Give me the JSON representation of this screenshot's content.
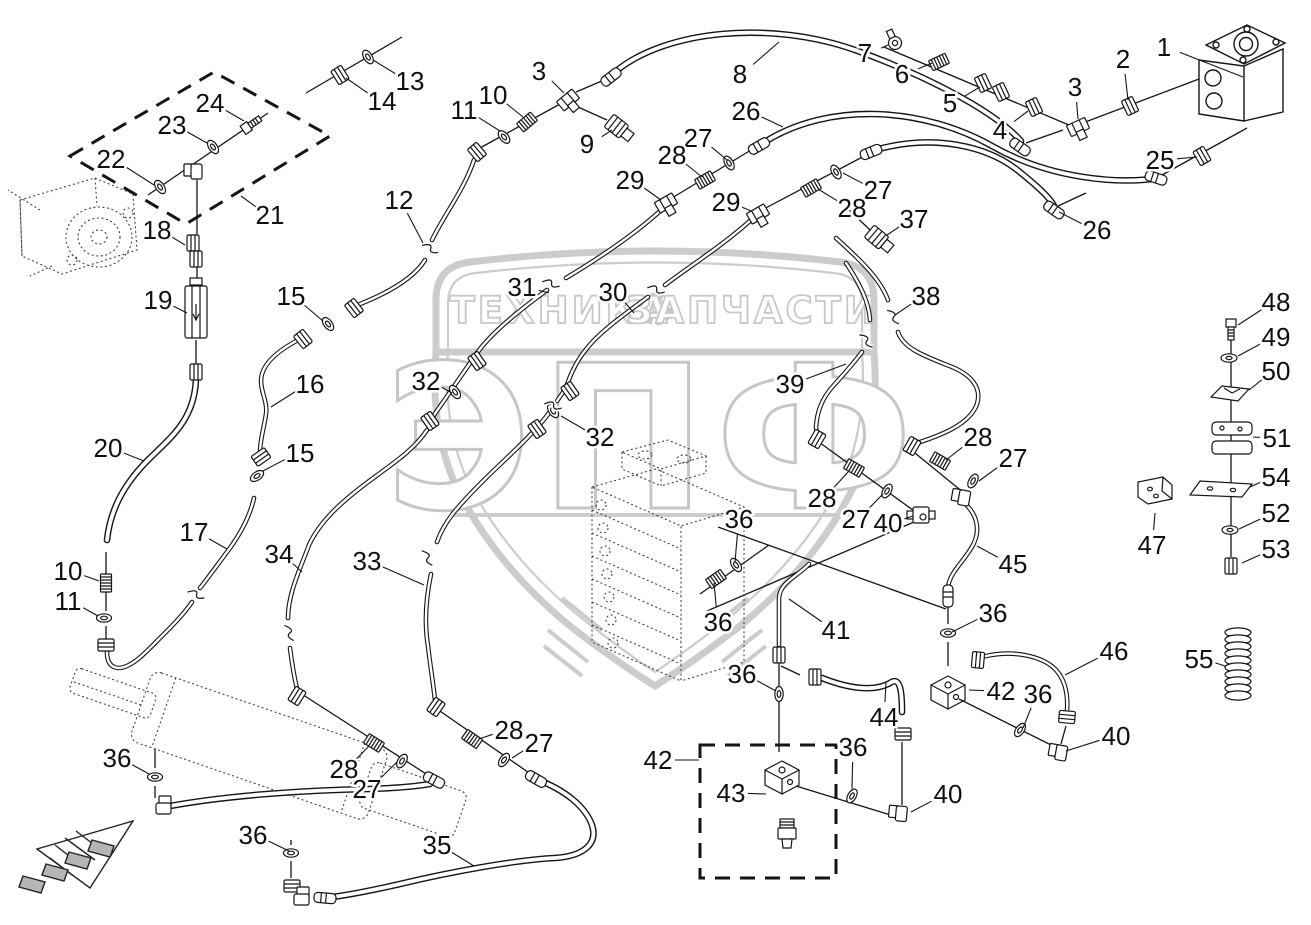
{
  "page": {
    "background": "#ffffff",
    "ink": "#151515"
  },
  "watermark": {
    "color": "#c8c8c8",
    "banner_left": "ТЕХНИКА",
    "banner_right": "ЗАПЧАСТИ",
    "big_text": "ЭПФ",
    "gear_icon": "gear-icon"
  },
  "callouts": [
    {
      "n": "1",
      "x": 1164,
      "y": 47,
      "tx": 1243,
      "ty": 77
    },
    {
      "n": "2",
      "x": 1123,
      "y": 59,
      "tx": 1128,
      "ty": 100
    },
    {
      "n": "3",
      "x": 1075,
      "y": 87,
      "tx": 1078,
      "ty": 119
    },
    {
      "n": "4",
      "x": 1000,
      "y": 130,
      "tx": 1028,
      "ty": 111
    },
    {
      "n": "5",
      "x": 950,
      "y": 103,
      "tx": 980,
      "ty": 87
    },
    {
      "n": "6",
      "x": 902,
      "y": 74,
      "tx": 932,
      "ty": 63
    },
    {
      "n": "7",
      "x": 865,
      "y": 53,
      "tx": 888,
      "ty": 45
    },
    {
      "n": "8",
      "x": 740,
      "y": 74,
      "tx": 779,
      "ty": 42
    },
    {
      "n": "9",
      "x": 587,
      "y": 144,
      "tx": 612,
      "ty": 130
    },
    {
      "n": "3",
      "x": 539,
      "y": 71,
      "tx": 564,
      "ty": 93
    },
    {
      "n": "10",
      "x": 493,
      "y": 95,
      "tx": 523,
      "ty": 117
    },
    {
      "n": "11",
      "x": 464,
      "y": 110,
      "tx": 500,
      "ty": 131
    },
    {
      "n": "12",
      "x": 399,
      "y": 200,
      "tx": 423,
      "ty": 243
    },
    {
      "n": "13",
      "x": 410,
      "y": 81,
      "tx": 373,
      "ty": 60
    },
    {
      "n": "14",
      "x": 382,
      "y": 101,
      "tx": 346,
      "ty": 78
    },
    {
      "n": "24",
      "x": 210,
      "y": 103,
      "tx": 244,
      "ty": 121
    },
    {
      "n": "23",
      "x": 172,
      "y": 125,
      "tx": 207,
      "ty": 143
    },
    {
      "n": "22",
      "x": 111,
      "y": 159,
      "tx": 154,
      "ty": 185
    },
    {
      "n": "21",
      "x": 270,
      "y": 215,
      "tx": 241,
      "ty": 196
    },
    {
      "n": "18",
      "x": 157,
      "y": 230,
      "tx": 185,
      "ty": 245
    },
    {
      "n": "19",
      "x": 158,
      "y": 300,
      "tx": 187,
      "ty": 313
    },
    {
      "n": "20",
      "x": 108,
      "y": 448,
      "tx": 144,
      "ty": 461
    },
    {
      "n": "15",
      "x": 291,
      "y": 296,
      "tx": 323,
      "ty": 321
    },
    {
      "n": "16",
      "x": 310,
      "y": 384,
      "tx": 271,
      "ty": 407
    },
    {
      "n": "15",
      "x": 300,
      "y": 453,
      "tx": 263,
      "ty": 471
    },
    {
      "n": "17",
      "x": 194,
      "y": 532,
      "tx": 227,
      "ty": 549
    },
    {
      "n": "10",
      "x": 68,
      "y": 571,
      "tx": 99,
      "ty": 581
    },
    {
      "n": "11",
      "x": 68,
      "y": 601,
      "tx": 98,
      "ty": 616
    },
    {
      "n": "26",
      "x": 746,
      "y": 111,
      "tx": 783,
      "ty": 127
    },
    {
      "n": "27",
      "x": 698,
      "y": 138,
      "tx": 727,
      "ty": 160
    },
    {
      "n": "28",
      "x": 672,
      "y": 155,
      "tx": 702,
      "ty": 177
    },
    {
      "n": "29",
      "x": 630,
      "y": 180,
      "tx": 661,
      "ty": 200
    },
    {
      "n": "29",
      "x": 726,
      "y": 202,
      "tx": 751,
      "ty": 211
    },
    {
      "n": "27",
      "x": 878,
      "y": 190,
      "tx": 843,
      "ty": 173
    },
    {
      "n": "28",
      "x": 852,
      "y": 208,
      "tx": 818,
      "ty": 189
    },
    {
      "n": "37",
      "x": 914,
      "y": 219,
      "tx": 887,
      "ty": 235
    },
    {
      "n": "26",
      "x": 1097,
      "y": 230,
      "tx": 1059,
      "ty": 212
    },
    {
      "n": "25",
      "x": 1160,
      "y": 160,
      "tx": 1197,
      "ty": 157
    },
    {
      "n": "31",
      "x": 522,
      "y": 287,
      "tx": 549,
      "ty": 293
    },
    {
      "n": "30",
      "x": 613,
      "y": 292,
      "tx": 634,
      "ty": 313
    },
    {
      "n": "38",
      "x": 926,
      "y": 296,
      "tx": 895,
      "ty": 315
    },
    {
      "n": "39",
      "x": 790,
      "y": 384,
      "tx": 846,
      "ty": 364
    },
    {
      "n": "32",
      "x": 426,
      "y": 381,
      "tx": 452,
      "ty": 393
    },
    {
      "n": "32",
      "x": 600,
      "y": 437,
      "tx": 561,
      "ty": 416
    },
    {
      "n": "28",
      "x": 978,
      "y": 437,
      "tx": 946,
      "ty": 460
    },
    {
      "n": "27",
      "x": 1013,
      "y": 458,
      "tx": 979,
      "ty": 481
    },
    {
      "n": "28",
      "x": 822,
      "y": 498,
      "tx": 849,
      "ty": 471
    },
    {
      "n": "27",
      "x": 856,
      "y": 519,
      "tx": 883,
      "ty": 494
    },
    {
      "n": "40",
      "x": 888,
      "y": 523,
      "tx": 913,
      "ty": 516
    },
    {
      "n": "45",
      "x": 1013,
      "y": 564,
      "tx": 977,
      "ty": 546
    },
    {
      "n": "36",
      "x": 739,
      "y": 519,
      "tx": 735,
      "ty": 562
    },
    {
      "n": "36",
      "x": 718,
      "y": 622,
      "tx": 714,
      "ty": 583
    },
    {
      "n": "41",
      "x": 836,
      "y": 630,
      "tx": 789,
      "ty": 599
    },
    {
      "n": "36",
      "x": 993,
      "y": 613,
      "tx": 952,
      "ty": 632
    },
    {
      "n": "42",
      "x": 1001,
      "y": 691,
      "tx": 969,
      "ty": 690
    },
    {
      "n": "36",
      "x": 1038,
      "y": 694,
      "tx": 1023,
      "ty": 728
    },
    {
      "n": "46",
      "x": 1114,
      "y": 651,
      "tx": 1065,
      "ty": 675
    },
    {
      "n": "40",
      "x": 1116,
      "y": 736,
      "tx": 1066,
      "ty": 751
    },
    {
      "n": "44",
      "x": 884,
      "y": 717,
      "tx": 886,
      "ty": 682
    },
    {
      "n": "36",
      "x": 742,
      "y": 674,
      "tx": 776,
      "ty": 691
    },
    {
      "n": "42",
      "x": 658,
      "y": 760,
      "tx": 699,
      "ty": 760
    },
    {
      "n": "43",
      "x": 731,
      "y": 793,
      "tx": 766,
      "ty": 794
    },
    {
      "n": "36",
      "x": 853,
      "y": 747,
      "tx": 852,
      "ty": 789
    },
    {
      "n": "40",
      "x": 948,
      "y": 794,
      "tx": 911,
      "ty": 812
    },
    {
      "n": "34",
      "x": 279,
      "y": 554,
      "tx": 302,
      "ty": 572
    },
    {
      "n": "33",
      "x": 367,
      "y": 561,
      "tx": 424,
      "ty": 585
    },
    {
      "n": "28",
      "x": 344,
      "y": 769,
      "tx": 369,
      "ty": 746
    },
    {
      "n": "27",
      "x": 367,
      "y": 789,
      "tx": 397,
      "ty": 762
    },
    {
      "n": "28",
      "x": 509,
      "y": 730,
      "tx": 479,
      "ty": 739
    },
    {
      "n": "27",
      "x": 539,
      "y": 743,
      "tx": 512,
      "ty": 758
    },
    {
      "n": "35",
      "x": 437,
      "y": 845,
      "tx": 474,
      "ty": 866
    },
    {
      "n": "36",
      "x": 117,
      "y": 758,
      "tx": 149,
      "ty": 774
    },
    {
      "n": "36",
      "x": 253,
      "y": 835,
      "tx": 289,
      "ty": 851
    },
    {
      "n": "47",
      "x": 1152,
      "y": 545,
      "tx": 1155,
      "ty": 513
    },
    {
      "n": "48",
      "x": 1276,
      "y": 302,
      "tx": 1238,
      "ty": 325
    },
    {
      "n": "49",
      "x": 1276,
      "y": 337,
      "tx": 1238,
      "ty": 356
    },
    {
      "n": "50",
      "x": 1276,
      "y": 371,
      "tx": 1249,
      "ty": 390
    },
    {
      "n": "51",
      "x": 1277,
      "y": 438,
      "tx": 1253,
      "ty": 437
    },
    {
      "n": "54",
      "x": 1276,
      "y": 477,
      "tx": 1250,
      "ty": 487
    },
    {
      "n": "52",
      "x": 1276,
      "y": 513,
      "tx": 1239,
      "ty": 529
    },
    {
      "n": "53",
      "x": 1276,
      "y": 549,
      "tx": 1242,
      "ty": 563
    },
    {
      "n": "55",
      "x": 1199,
      "y": 659,
      "tx": 1225,
      "ty": 666
    }
  ],
  "fittings": [
    {
      "t": "ring",
      "x": 368,
      "y": 57,
      "a": -32
    },
    {
      "t": "nut",
      "x": 340,
      "y": 75,
      "a": -32
    },
    {
      "t": "ring",
      "x": 160,
      "y": 187,
      "a": -35
    },
    {
      "t": "ring",
      "x": 213,
      "y": 147,
      "a": -35
    },
    {
      "t": "bolt",
      "x": 252,
      "y": 124,
      "a": -35
    },
    {
      "t": "elbow",
      "x": 194,
      "y": 170,
      "a": 0
    },
    {
      "t": "nut",
      "x": 193,
      "y": 243,
      "a": 0
    },
    {
      "t": "nut",
      "x": 196,
      "y": 259,
      "a": 0
    },
    {
      "t": "valve",
      "x": 196,
      "y": 312,
      "a": 0
    },
    {
      "t": "nut",
      "x": 196,
      "y": 372,
      "a": 0
    },
    {
      "t": "stud",
      "x": 106,
      "y": 583,
      "a": 90
    },
    {
      "t": "ring",
      "x": 104,
      "y": 618,
      "a": 90
    },
    {
      "t": "nut",
      "x": 106,
      "y": 645,
      "a": 90
    },
    {
      "t": "ring",
      "x": 155,
      "y": 777,
      "a": 90
    },
    {
      "t": "elbow",
      "x": 165,
      "y": 806,
      "a": 90
    },
    {
      "t": "ring",
      "x": 291,
      "y": 853,
      "a": 90
    },
    {
      "t": "nut",
      "x": 292,
      "y": 886,
      "a": 90
    },
    {
      "t": "elbow",
      "x": 303,
      "y": 897,
      "a": 90
    },
    {
      "t": "crimp",
      "x": 325,
      "y": 898,
      "a": 5
    },
    {
      "t": "ring",
      "x": 257,
      "y": 476,
      "a": 55
    },
    {
      "t": "nut",
      "x": 261,
      "y": 457,
      "a": 55
    },
    {
      "t": "nut",
      "x": 303,
      "y": 339,
      "a": -38
    },
    {
      "t": "ring",
      "x": 328,
      "y": 324,
      "a": -38
    },
    {
      "t": "nut",
      "x": 354,
      "y": 308,
      "a": -38
    },
    {
      "t": "nut",
      "x": 477,
      "y": 152,
      "a": -40
    },
    {
      "t": "ring",
      "x": 504,
      "y": 137,
      "a": -40
    },
    {
      "t": "stud",
      "x": 527,
      "y": 122,
      "a": -40
    },
    {
      "t": "tee",
      "x": 568,
      "y": 100,
      "a": -40
    },
    {
      "t": "crimp",
      "x": 611,
      "y": 77,
      "a": -38
    },
    {
      "t": "sensor",
      "x": 620,
      "y": 129,
      "a": 38
    },
    {
      "t": "crimp",
      "x": 1020,
      "y": 147,
      "a": 35
    },
    {
      "t": "tee",
      "x": 1078,
      "y": 127,
      "a": -25
    },
    {
      "t": "nut",
      "x": 1034,
      "y": 107,
      "a": -25
    },
    {
      "t": "nut",
      "x": 1001,
      "y": 92,
      "a": -25
    },
    {
      "t": "nut",
      "x": 983,
      "y": 83,
      "a": -25
    },
    {
      "t": "stud",
      "x": 939,
      "y": 62,
      "a": -25
    },
    {
      "t": "banjo",
      "x": 895,
      "y": 43,
      "a": -25
    },
    {
      "t": "nut",
      "x": 1130,
      "y": 106,
      "a": -25
    },
    {
      "t": "crimp",
      "x": 759,
      "y": 146,
      "a": -30
    },
    {
      "t": "ring",
      "x": 729,
      "y": 163,
      "a": -30
    },
    {
      "t": "stud",
      "x": 705,
      "y": 180,
      "a": -30
    },
    {
      "t": "tee",
      "x": 666,
      "y": 203,
      "a": -30
    },
    {
      "t": "crimp",
      "x": 1156,
      "y": 178,
      "a": 18
    },
    {
      "t": "nut",
      "x": 1202,
      "y": 156,
      "a": -30
    },
    {
      "t": "crimp",
      "x": 871,
      "y": 152,
      "a": -22
    },
    {
      "t": "ring",
      "x": 836,
      "y": 172,
      "a": -30
    },
    {
      "t": "stud",
      "x": 811,
      "y": 188,
      "a": -30
    },
    {
      "t": "tee",
      "x": 758,
      "y": 214,
      "a": -30
    },
    {
      "t": "crimp",
      "x": 1054,
      "y": 210,
      "a": 35
    },
    {
      "t": "sensor",
      "x": 880,
      "y": 240,
      "a": 40
    },
    {
      "t": "nut",
      "x": 477,
      "y": 361,
      "a": -35
    },
    {
      "t": "ring",
      "x": 455,
      "y": 392,
      "a": -35
    },
    {
      "t": "nut",
      "x": 430,
      "y": 421,
      "a": -35
    },
    {
      "t": "nut",
      "x": 570,
      "y": 391,
      "a": -35
    },
    {
      "t": "ring",
      "x": 553,
      "y": 411,
      "a": -35
    },
    {
      "t": "nut",
      "x": 537,
      "y": 429,
      "a": -35
    },
    {
      "t": "nut",
      "x": 297,
      "y": 696,
      "a": 32
    },
    {
      "t": "stud",
      "x": 374,
      "y": 743,
      "a": 32
    },
    {
      "t": "ring",
      "x": 402,
      "y": 761,
      "a": 32
    },
    {
      "t": "crimp",
      "x": 434,
      "y": 780,
      "a": 28
    },
    {
      "t": "nut",
      "x": 436,
      "y": 707,
      "a": 35
    },
    {
      "t": "stud",
      "x": 472,
      "y": 739,
      "a": 35
    },
    {
      "t": "ring",
      "x": 504,
      "y": 760,
      "a": 35
    },
    {
      "t": "crimp",
      "x": 536,
      "y": 779,
      "a": 30
    },
    {
      "t": "nut",
      "x": 912,
      "y": 446,
      "a": 30
    },
    {
      "t": "stud",
      "x": 940,
      "y": 461,
      "a": 30
    },
    {
      "t": "ring",
      "x": 973,
      "y": 481,
      "a": 30
    },
    {
      "t": "elbow",
      "x": 962,
      "y": 496,
      "a": 10
    },
    {
      "t": "crimp",
      "x": 948,
      "y": 596,
      "a": 90
    },
    {
      "t": "ring",
      "x": 948,
      "y": 633,
      "a": 90
    },
    {
      "t": "block",
      "x": 948,
      "y": 690,
      "a": 0
    },
    {
      "t": "nut",
      "x": 817,
      "y": 439,
      "a": 30
    },
    {
      "t": "stud",
      "x": 854,
      "y": 468,
      "a": 30
    },
    {
      "t": "ring",
      "x": 887,
      "y": 491,
      "a": 30
    },
    {
      "t": "cross",
      "x": 921,
      "y": 515,
      "a": 0
    },
    {
      "t": "ring",
      "x": 736,
      "y": 565,
      "a": -35
    },
    {
      "t": "stud",
      "x": 716,
      "y": 579,
      "a": -35
    },
    {
      "t": "nut",
      "x": 779,
      "y": 655,
      "a": 0
    },
    {
      "t": "ring",
      "x": 779,
      "y": 694,
      "a": 0
    },
    {
      "t": "nut",
      "x": 815,
      "y": 677,
      "a": 0
    },
    {
      "t": "ring",
      "x": 1020,
      "y": 730,
      "a": 35
    },
    {
      "t": "elbow",
      "x": 1059,
      "y": 751,
      "a": 10
    },
    {
      "t": "nut",
      "x": 1067,
      "y": 717,
      "a": 95
    },
    {
      "t": "nut",
      "x": 978,
      "y": 660,
      "a": 5
    },
    {
      "t": "nut",
      "x": 903,
      "y": 734,
      "a": 90
    },
    {
      "t": "elbow",
      "x": 899,
      "y": 812,
      "a": 5
    },
    {
      "t": "ring",
      "x": 852,
      "y": 796,
      "a": 30
    },
    {
      "t": "block",
      "x": 782,
      "y": 775,
      "a": 0
    },
    {
      "t": "valve43",
      "x": 787,
      "y": 833,
      "a": 0
    },
    {
      "t": "bolt",
      "x": 1231,
      "y": 330,
      "a": 90
    },
    {
      "t": "washer",
      "x": 1229,
      "y": 358,
      "a": 0
    },
    {
      "t": "clamp",
      "x": 1230,
      "y": 394,
      "a": 0
    },
    {
      "t": "clamp2",
      "x": 1232,
      "y": 438,
      "a": 0
    },
    {
      "t": "plate",
      "x": 1221,
      "y": 488,
      "a": 0
    },
    {
      "t": "washer",
      "x": 1230,
      "y": 530,
      "a": 0
    },
    {
      "t": "nut",
      "x": 1231,
      "y": 566,
      "a": 0
    },
    {
      "t": "bracket",
      "x": 1155,
      "y": 494,
      "a": 0
    },
    {
      "t": "coil",
      "x": 1238,
      "y": 664,
      "a": 0
    },
    {
      "t": "brk",
      "x": 430,
      "y": 249,
      "a": 50
    },
    {
      "t": "brk",
      "x": 551,
      "y": 284,
      "a": 40
    },
    {
      "t": "brk",
      "x": 656,
      "y": 290,
      "a": 40
    },
    {
      "t": "brk",
      "x": 427,
      "y": 558,
      "a": 80
    },
    {
      "t": "brk",
      "x": 289,
      "y": 633,
      "a": 85
    },
    {
      "t": "brk",
      "x": 893,
      "y": 317,
      "a": 75
    },
    {
      "t": "brk",
      "x": 866,
      "y": 341,
      "a": 70
    },
    {
      "t": "brk",
      "x": 196,
      "y": 595,
      "a": 45
    },
    {
      "t": "brk",
      "x": 553,
      "y": 406,
      "a": 40
    }
  ]
}
